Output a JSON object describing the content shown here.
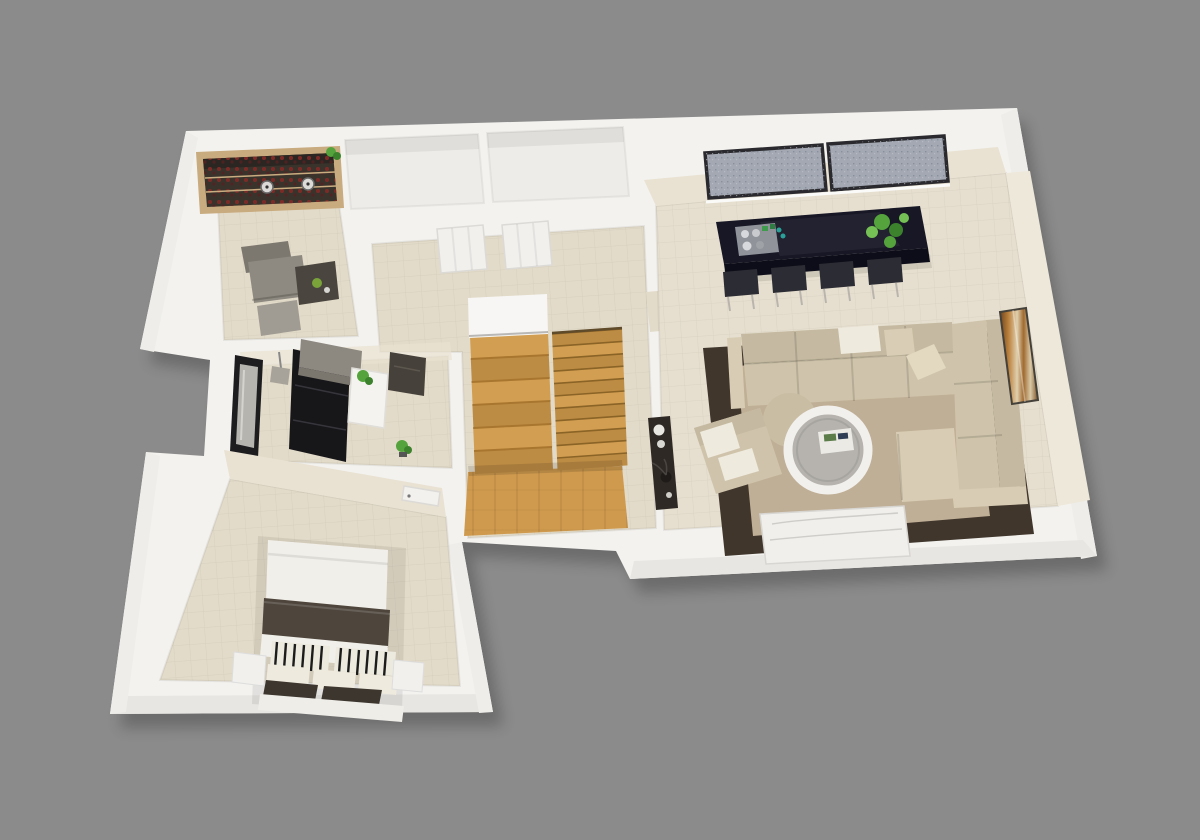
{
  "scene": {
    "type": "3d-floor-plan-render",
    "view": "isometric-top-down",
    "background": "#8b8b8b",
    "rooms": [
      {
        "name": "office",
        "furniture": [
          "wine-rack",
          "pendant-lamps",
          "office-chair",
          "side-table",
          "green-apple",
          "floor-cushion",
          "shelf-plant"
        ]
      },
      {
        "name": "closet-left",
        "furniture": [
          "closet-door"
        ]
      },
      {
        "name": "closet-right",
        "furniture": [
          "closet-door"
        ]
      },
      {
        "name": "stair-hall",
        "furniture": [
          "staircase-upper-flight",
          "staircase-lower-flight",
          "wood-landing"
        ]
      },
      {
        "name": "entry-hall",
        "furniture": [
          "black-wardrobe-door",
          "wall-cabinet",
          "pendant-lamp",
          "slim-window",
          "console-shelf",
          "potted-plants",
          "dark-sideboard"
        ]
      },
      {
        "name": "bedroom",
        "furniture": [
          "double-bed",
          "striped-pillows",
          "dark-blanket",
          "nightstand-left",
          "nightstand-right",
          "bedroom-door"
        ]
      },
      {
        "name": "living-kitchen",
        "furniture": [
          "double-window",
          "kitchen-island",
          "cooktop",
          "bar-stools",
          "island-plant",
          "sectional-sofa",
          "throw-pillows",
          "round-ottoman",
          "round-coffee-table",
          "magazine",
          "armchair",
          "media-console",
          "marble-tv-bench",
          "area-rug",
          "wall-art"
        ]
      }
    ]
  },
  "palette": {
    "bg": "#8b8b8b",
    "wall": "#f3f2ef",
    "wallBright": "#f7f6f4",
    "wallShadeRight": "#eeede9",
    "wallShadeBottom": "#e8e6e2",
    "wallFaceBeige": "#e9e2d2",
    "floor": "#e3dbc9",
    "floorLiving": "#e6dfcf",
    "floorClosets": "#eeece8",
    "wood": "#d29e52",
    "woodDark": "#bd8c44",
    "woodLanding": "#cf9a4e",
    "island": "#171726",
    "islandFront": "#0d0d19",
    "cooktop": "#90939a",
    "stool": "#2c2c34",
    "metal": "#b9b5ae",
    "plantGreen": "#55a33c",
    "plantDark": "#3c822c",
    "rug": "#40362c",
    "rugCenter": "#c0af97",
    "sofa": "#cfc4ab",
    "sofaBack": "#c5baa1",
    "sofaLight": "#d8cdb4",
    "pillowWhite": "#efeade",
    "pillowBeige": "#d9ceb5",
    "console": "#2e2925",
    "tableTop": "#b6b3ae",
    "tableRim": "#f2f0ec",
    "bench": "#f0efec",
    "doorBlack": "#17171a",
    "cabinetGray": "#8d8880",
    "glass": "#a3a8b2",
    "windowFrame": "#2a2a2e",
    "bottleRed": "#7d2a26",
    "rackWood": "#c8ab7e",
    "rackDark": "#3a332c",
    "blanket": "#4e463d",
    "duvet": "#f1efe9",
    "throwDark": "#3c362f",
    "chairGray": "#8e8a81",
    "chairGrayDark": "#7c786f"
  }
}
